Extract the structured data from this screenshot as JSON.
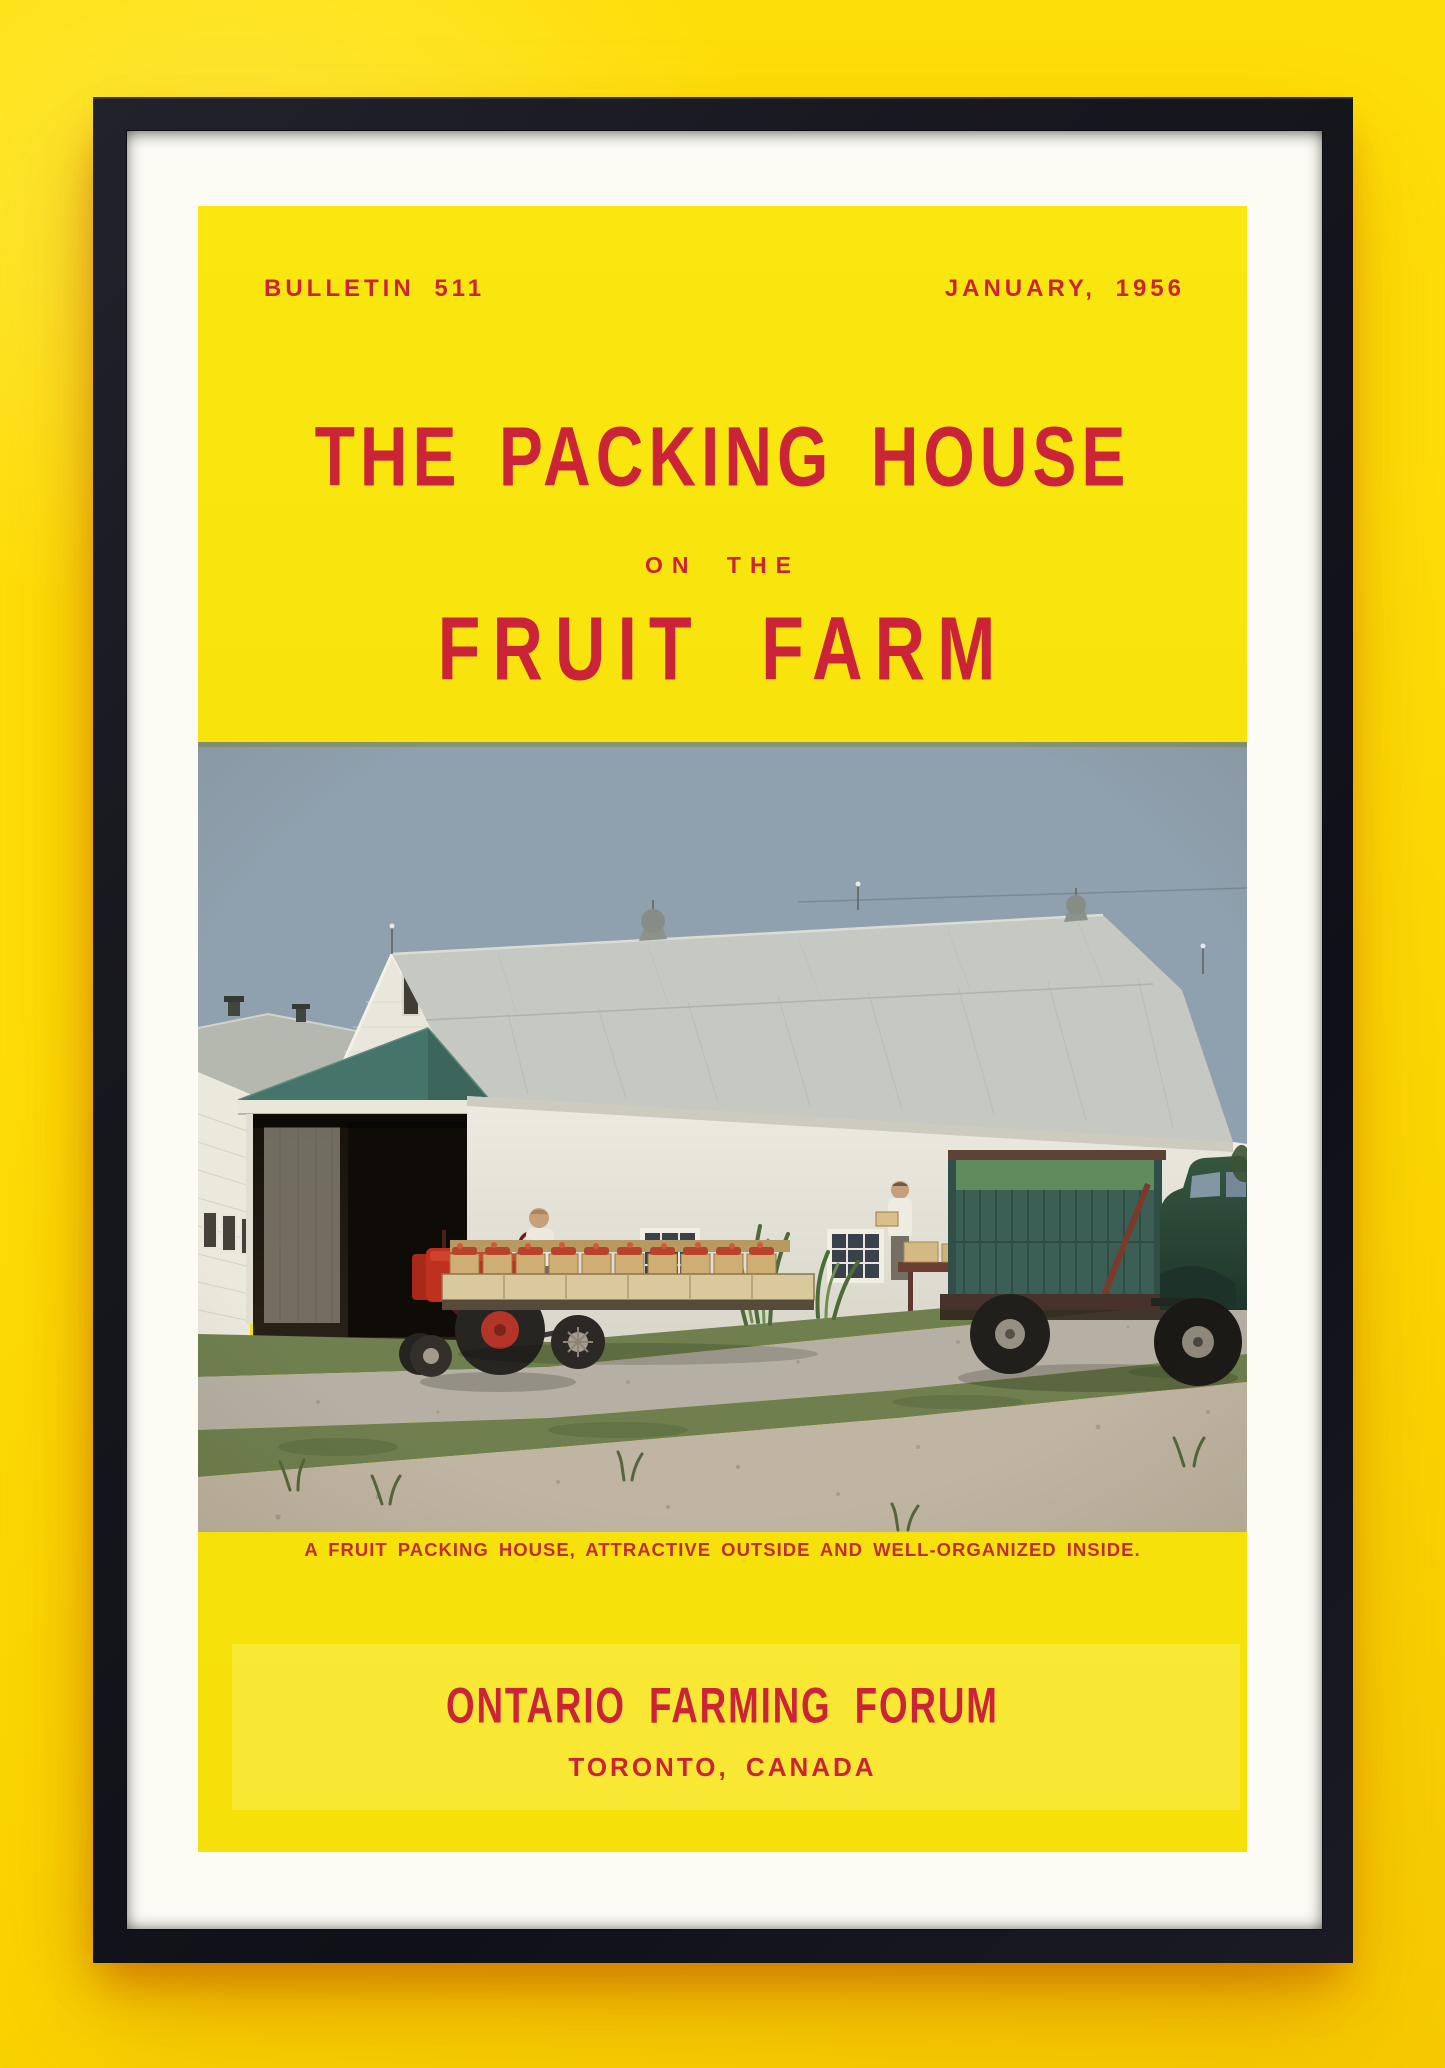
{
  "poster": {
    "header": {
      "bulletin": "BULLETIN 511",
      "date": "JANUARY, 1956"
    },
    "title": {
      "line1": "THE PACKING HOUSE",
      "line2": "ON THE",
      "line3": "FRUIT FARM"
    },
    "photo": {
      "caption": "A FRUIT PACKING HOUSE, ATTRACTIVE OUTSIDE AND WELL-ORGANIZED INSIDE."
    },
    "footer": {
      "organization": "ONTARIO FARMING FORUM",
      "location": "TORONTO, CANADA"
    }
  },
  "colors": {
    "wall_yellow": "#fede07",
    "wall_deep": "#f6c900",
    "panel_yellow": "#f7e30b",
    "page_white": "#fcfbf4",
    "frame_black": "#17171e",
    "accent_red": "#cb2438",
    "caption_red": "#c22c36",
    "sky": "#8fa0ae",
    "roof_gray": "#c6c9c2",
    "canopy_green": "#45746a",
    "truck_green": "#3c5f55",
    "truck_cab": "#2c4b3d",
    "tractor_red": "#bf301e",
    "grass": "#6f7f4e",
    "gravel": "#b6b0a4",
    "dirt": "#c0b5a2"
  }
}
